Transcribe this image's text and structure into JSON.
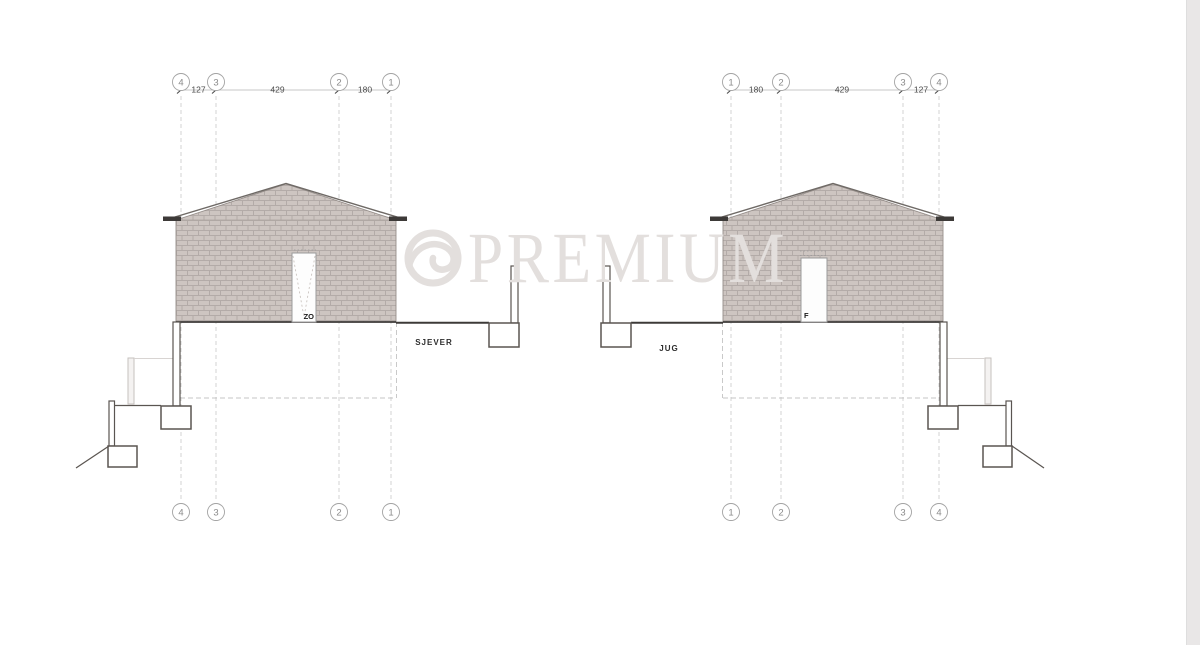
{
  "drawing": {
    "watermark": "PREMIUM",
    "north_elevation": {
      "label": "SJEVER",
      "door_label": "ZO",
      "grid_labels": [
        "4",
        "3",
        "2",
        "1"
      ],
      "dimensions": [
        "127",
        "429",
        "180"
      ]
    },
    "south_elevation": {
      "label": "JUG",
      "door_label": "F",
      "grid_labels": [
        "1",
        "2",
        "3",
        "4"
      ],
      "dimensions": [
        "180",
        "429",
        "127"
      ]
    },
    "colors": {
      "brick": "#cdc5c1",
      "mortar": "#b3aba8",
      "watermark_gray": "#e3dfdd",
      "line_dark": "#3d3a38"
    }
  }
}
